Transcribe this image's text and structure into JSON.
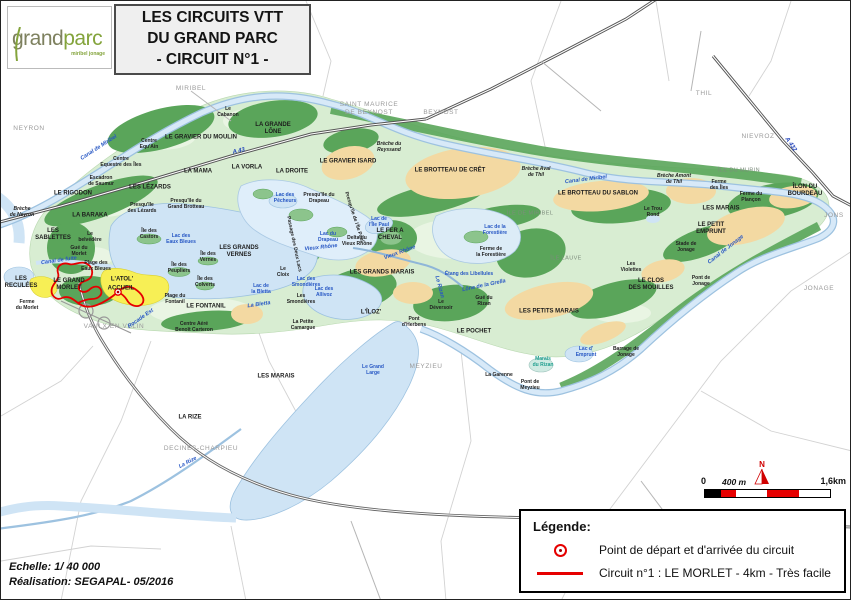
{
  "header": {
    "logo": {
      "part1": "grand",
      "part2": "parc",
      "sub": "miribel jonage"
    },
    "title_lines": [
      "LES CIRCUITS VTT",
      "DU GRAND PARC",
      "- CIRCUIT N°1 -"
    ]
  },
  "footer": {
    "scale": "Echelle: 1/ 40 000",
    "credit": "Réalisation: SEGAPAL- 05/2016"
  },
  "scalebar": {
    "north": "N",
    "labels": [
      "0",
      "400 m",
      "1,6km"
    ]
  },
  "legend": {
    "title": "Légende:",
    "items": [
      {
        "symbol": "start-point",
        "label": "Point de départ et d'arrivée du circuit"
      },
      {
        "symbol": "circuit-line",
        "label": "Circuit n°1 : LE MORLET - 4km - Très facile"
      }
    ]
  },
  "colors": {
    "circuit_red": "#e60000",
    "water_fill": "#cfe4f5",
    "water_edge": "#9dc2e0",
    "forest_green": "#5aa55a",
    "park_green": "#d8edd2",
    "sand_tan": "#f3d9a2",
    "accueil_yellow": "#f7ef55",
    "logo_green": "#84a43c",
    "city_gray": "#9a9a9a",
    "label_blue": "#2757c4"
  },
  "map": {
    "labels": [
      {
        "t": "MIRIBEL",
        "x": 190,
        "y": 88,
        "c": "city"
      },
      {
        "t": "SAINT MAURICE\nDE BEYNOST",
        "x": 368,
        "y": 108,
        "c": "city"
      },
      {
        "t": "BEYNOST",
        "x": 440,
        "y": 112,
        "c": "city"
      },
      {
        "t": "THIL",
        "x": 703,
        "y": 93,
        "c": "city"
      },
      {
        "t": "NIEVROZ",
        "x": 757,
        "y": 136,
        "c": "city"
      },
      {
        "t": "JONS",
        "x": 833,
        "y": 215,
        "c": "city"
      },
      {
        "t": "JONAGE",
        "x": 818,
        "y": 288,
        "c": "city"
      },
      {
        "t": "MEYZIEU",
        "x": 425,
        "y": 366,
        "c": "city"
      },
      {
        "t": "VAULX EN VELIN",
        "x": 113,
        "y": 326,
        "c": "city"
      },
      {
        "t": "DECINES-CHARPIEU",
        "x": 200,
        "y": 448,
        "c": "city"
      },
      {
        "t": "NEYRON",
        "x": 28,
        "y": 128,
        "c": "city"
      },
      {
        "t": "LE GRAVIER DU MOULIN",
        "x": 200,
        "y": 137,
        "c": "major"
      },
      {
        "t": "LA GRANDE\nLÔNE",
        "x": 272,
        "y": 128,
        "c": "major"
      },
      {
        "t": "LE GRAVIER ISARD",
        "x": 347,
        "y": 161,
        "c": "major"
      },
      {
        "t": "LE BROTTEAU DE CRÊT",
        "x": 449,
        "y": 170,
        "c": "major"
      },
      {
        "t": "LE BROTTEAU DU SABLON",
        "x": 597,
        "y": 193,
        "c": "major"
      },
      {
        "t": "LE FER A\nCHEVAL",
        "x": 389,
        "y": 234,
        "c": "major"
      },
      {
        "t": "LES GRANDS MARAIS",
        "x": 381,
        "y": 272,
        "c": "major"
      },
      {
        "t": "LES GRANDS\nVERNES",
        "x": 238,
        "y": 251,
        "c": "major"
      },
      {
        "t": "LE RIGODON",
        "x": 72,
        "y": 193,
        "c": "major"
      },
      {
        "t": "LES LÉZARDS",
        "x": 149,
        "y": 187,
        "c": "major"
      },
      {
        "t": "LA MAMA",
        "x": 197,
        "y": 171,
        "c": "major"
      },
      {
        "t": "LA VORLA",
        "x": 246,
        "y": 167,
        "c": "major"
      },
      {
        "t": "LA DROITE",
        "x": 291,
        "y": 171,
        "c": "major"
      },
      {
        "t": "LA BARAKA",
        "x": 89,
        "y": 215,
        "c": "major"
      },
      {
        "t": "LES\nSABLETTES",
        "x": 52,
        "y": 234,
        "c": "major"
      },
      {
        "t": "LES\nRECULÉES",
        "x": 20,
        "y": 282,
        "c": "major"
      },
      {
        "t": "LE GRAND\nMORLET",
        "x": 68,
        "y": 284,
        "c": "major"
      },
      {
        "t": "L'ATOL'",
        "x": 121,
        "y": 279,
        "c": "major"
      },
      {
        "t": "ACCUEIL",
        "x": 120,
        "y": 288,
        "c": "major"
      },
      {
        "t": "LE FONTANIL",
        "x": 205,
        "y": 306,
        "c": "major"
      },
      {
        "t": "LES MARAIS",
        "x": 275,
        "y": 376,
        "c": "major"
      },
      {
        "t": "LA RIZE",
        "x": 189,
        "y": 417,
        "c": "major"
      },
      {
        "t": "L'ÎLOZ'",
        "x": 370,
        "y": 312,
        "c": "major"
      },
      {
        "t": "LE POCHET",
        "x": 473,
        "y": 331,
        "c": "major"
      },
      {
        "t": "LES PETITS MARAIS",
        "x": 548,
        "y": 311,
        "c": "major"
      },
      {
        "t": "LE CLOS\nDES MOUILLES",
        "x": 650,
        "y": 284,
        "c": "major"
      },
      {
        "t": "LE PETIT\nEMPRUNT",
        "x": 710,
        "y": 228,
        "c": "major"
      },
      {
        "t": "LES MARAIS",
        "x": 720,
        "y": 208,
        "c": "major"
      },
      {
        "t": "ÎLON DU BOURDEAU",
        "x": 804,
        "y": 190,
        "c": "major"
      },
      {
        "t": "ÎLE DE MIRIBEL",
        "x": 529,
        "y": 213,
        "c": "light"
      },
      {
        "t": "ÎLE LAUVE",
        "x": 565,
        "y": 258,
        "c": "light"
      },
      {
        "t": "ÎLE DU MURIN",
        "x": 738,
        "y": 170,
        "c": "light"
      },
      {
        "t": "Le\nCabanon",
        "x": 227,
        "y": 111,
        "c": "minor"
      },
      {
        "t": "Centre\nEqu'Ain",
        "x": 148,
        "y": 143,
        "c": "minor"
      },
      {
        "t": "Centre\nEquestre des Îles",
        "x": 120,
        "y": 161,
        "c": "minor"
      },
      {
        "t": "Escadron\nde Saumur",
        "x": 100,
        "y": 180,
        "c": "minor"
      },
      {
        "t": "Presqu'île\ndes Lézards",
        "x": 141,
        "y": 207,
        "c": "minor"
      },
      {
        "t": "Presqu'île du\nGrand Brotteau",
        "x": 185,
        "y": 203,
        "c": "minor"
      },
      {
        "t": "Le\nbelvédère",
        "x": 89,
        "y": 236,
        "c": "minor"
      },
      {
        "t": "Gué du\nMorlet",
        "x": 78,
        "y": 250,
        "c": "minor"
      },
      {
        "t": "Plage des\nEaux Bleues",
        "x": 95,
        "y": 265,
        "c": "minor"
      },
      {
        "t": "Ferme\ndu Morlet",
        "x": 26,
        "y": 304,
        "c": "minor"
      },
      {
        "t": "Île des\nCastors",
        "x": 148,
        "y": 233,
        "c": "minor"
      },
      {
        "t": "Île des\nVernes",
        "x": 207,
        "y": 256,
        "c": "minor"
      },
      {
        "t": "Île des\nPeupliers",
        "x": 178,
        "y": 267,
        "c": "minor"
      },
      {
        "t": "Île des\nColverts",
        "x": 204,
        "y": 281,
        "c": "minor"
      },
      {
        "t": "Le\nCloix",
        "x": 282,
        "y": 271,
        "c": "minor"
      },
      {
        "t": "Les\nSmondières",
        "x": 300,
        "y": 298,
        "c": "minor"
      },
      {
        "t": "La Petite\nCamargue",
        "x": 302,
        "y": 324,
        "c": "minor"
      },
      {
        "t": "Plage du\nFontanil",
        "x": 174,
        "y": 298,
        "c": "minor"
      },
      {
        "t": "Centre Aéré\nBenoît Carteron",
        "x": 193,
        "y": 326,
        "c": "minor"
      },
      {
        "t": "Presqu'île du\nDrapeau",
        "x": 318,
        "y": 197,
        "c": "minor"
      },
      {
        "t": "Delta du\nVieux Rhône",
        "x": 356,
        "y": 240,
        "c": "minor"
      },
      {
        "t": "Passage des Deux Lacs",
        "x": 293,
        "y": 243,
        "c": "minor",
        "r": 78
      },
      {
        "t": "Presqu'île de l'Île Paul",
        "x": 353,
        "y": 216,
        "c": "minor",
        "r": 72
      },
      {
        "t": "Ferme de\nla Forestière",
        "x": 490,
        "y": 251,
        "c": "minor"
      },
      {
        "t": "Gué du\nRizan",
        "x": 483,
        "y": 300,
        "c": "minor"
      },
      {
        "t": "Le\nDéversoir",
        "x": 440,
        "y": 304,
        "c": "minor"
      },
      {
        "t": "Pont\nd'Herbens",
        "x": 413,
        "y": 321,
        "c": "minor"
      },
      {
        "t": "La Garenne",
        "x": 498,
        "y": 374,
        "c": "minor"
      },
      {
        "t": "Pont de\nMeyzieu",
        "x": 529,
        "y": 384,
        "c": "minor"
      },
      {
        "t": "Le Trou\nRond",
        "x": 652,
        "y": 211,
        "c": "minor"
      },
      {
        "t": "Ferme\ndes Îles",
        "x": 718,
        "y": 184,
        "c": "minor"
      },
      {
        "t": "Ferme du\nPlançon",
        "x": 750,
        "y": 196,
        "c": "minor"
      },
      {
        "t": "Stade de\nJonage",
        "x": 685,
        "y": 246,
        "c": "minor"
      },
      {
        "t": "Les\nViolettes",
        "x": 630,
        "y": 266,
        "c": "minor"
      },
      {
        "t": "Pont de\nJonage",
        "x": 700,
        "y": 280,
        "c": "minor"
      },
      {
        "t": "Barrage de\nJonage",
        "x": 625,
        "y": 351,
        "c": "minor"
      },
      {
        "t": "Brèche\nde Neyron",
        "x": 21,
        "y": 211,
        "c": "breche"
      },
      {
        "t": "Brèche du\nReyssand",
        "x": 388,
        "y": 146,
        "c": "breche"
      },
      {
        "t": "Brèche Aval\nde Thil",
        "x": 535,
        "y": 171,
        "c": "breche"
      },
      {
        "t": "Brèche Amont\nde Thil",
        "x": 673,
        "y": 178,
        "c": "breche"
      },
      {
        "t": "Lac des\nEaux Bleues",
        "x": 180,
        "y": 238,
        "c": "water"
      },
      {
        "t": "Lac des\nPêcheurs",
        "x": 284,
        "y": 197,
        "c": "water"
      },
      {
        "t": "Lac du\nDrapeau",
        "x": 327,
        "y": 236,
        "c": "water"
      },
      {
        "t": "Lac de\nl'Île Paul",
        "x": 378,
        "y": 221,
        "c": "water"
      },
      {
        "t": "Lac de\nla Bletta",
        "x": 260,
        "y": 288,
        "c": "water"
      },
      {
        "t": "Lac des\nSmondières",
        "x": 305,
        "y": 281,
        "c": "water"
      },
      {
        "t": "Lac des\nAllivoz",
        "x": 323,
        "y": 291,
        "c": "water"
      },
      {
        "t": "Lac de la\nForestière",
        "x": 494,
        "y": 229,
        "c": "water"
      },
      {
        "t": "Lac d'\nEmprunt",
        "x": 585,
        "y": 351,
        "c": "water"
      },
      {
        "t": "Le Grand\nLarge",
        "x": 372,
        "y": 369,
        "c": "water"
      },
      {
        "t": "Étang des Libellules",
        "x": 468,
        "y": 273,
        "c": "water"
      },
      {
        "t": "Marais\ndu Rizan",
        "x": 542,
        "y": 361,
        "c": "teal"
      },
      {
        "t": "Canal de Miribel",
        "x": 98,
        "y": 147,
        "c": "stream",
        "r": -33
      },
      {
        "t": "Canal de Miribel",
        "x": 585,
        "y": 179,
        "c": "stream",
        "r": -7
      },
      {
        "t": "Canal de fuite",
        "x": 58,
        "y": 260,
        "c": "stream",
        "r": -8
      },
      {
        "t": "Canal de Jonage",
        "x": 725,
        "y": 249,
        "c": "stream",
        "r": -38
      },
      {
        "t": "Vieux Rhône",
        "x": 320,
        "y": 247,
        "c": "stream",
        "r": -6
      },
      {
        "t": "Vieux Rhône",
        "x": 399,
        "y": 252,
        "c": "stream",
        "r": -20
      },
      {
        "t": "La Bletta",
        "x": 258,
        "y": 304,
        "c": "stream",
        "r": -8
      },
      {
        "t": "Le Rizan",
        "x": 438,
        "y": 286,
        "c": "stream",
        "r": 75
      },
      {
        "t": "Lône de la Grella",
        "x": 483,
        "y": 285,
        "c": "stream",
        "r": -12
      },
      {
        "t": "La Rize",
        "x": 187,
        "y": 462,
        "c": "stream",
        "r": -28
      },
      {
        "t": "Rocade Est",
        "x": 140,
        "y": 318,
        "c": "stream",
        "r": -35
      },
      {
        "t": "A 43",
        "x": 238,
        "y": 151,
        "c": "hwy",
        "r": -13
      },
      {
        "t": "A 432",
        "x": 789,
        "y": 144,
        "c": "hwy",
        "r": 55
      }
    ]
  }
}
